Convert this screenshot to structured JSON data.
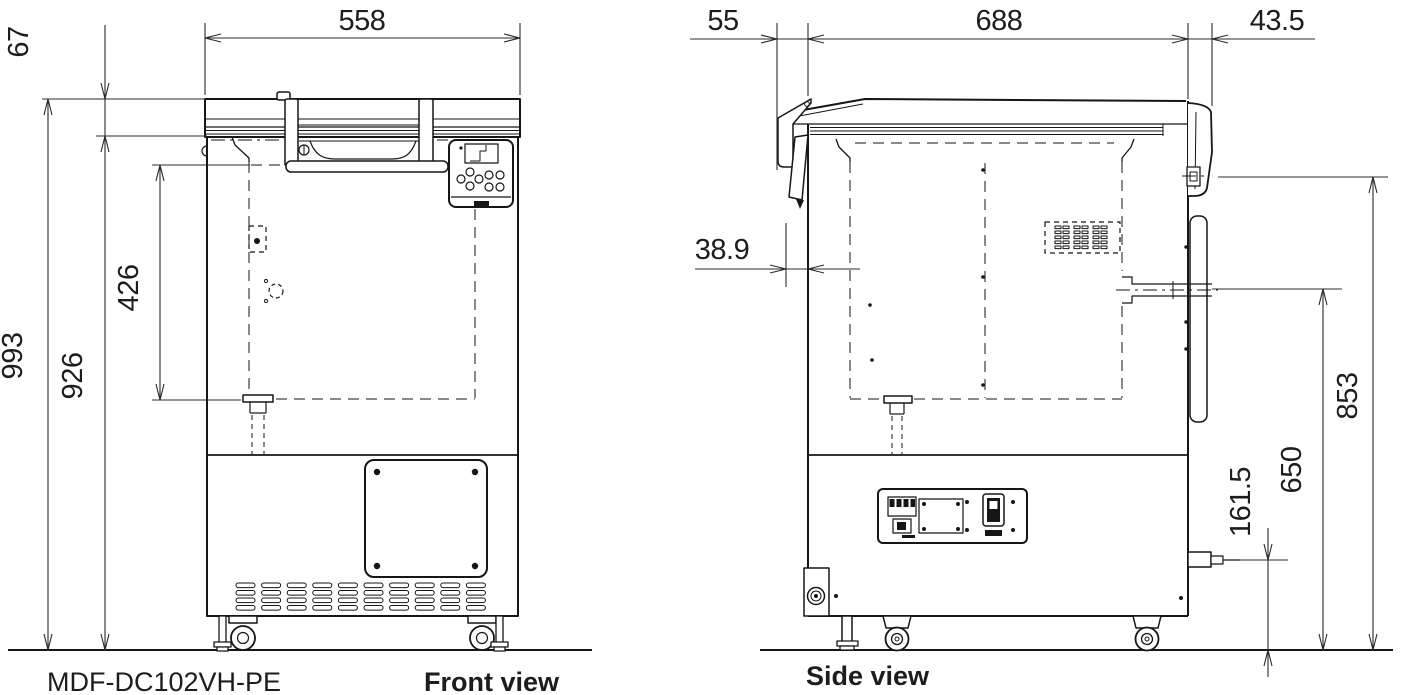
{
  "labels": {
    "model": "MDF-DC102VH-PE",
    "front_view": "Front view",
    "side_view": "Side view"
  },
  "dimensions_mm": {
    "front": {
      "overall_width": "558",
      "lid_thickness": "67",
      "overall_height": "993",
      "body_height": "926",
      "interior_height": "426"
    },
    "side": {
      "back_projection": "55",
      "body_depth": "688",
      "front_projection": "43.5",
      "hinge_projection": "38.9",
      "lid_top_height": "853",
      "access_port_height": "650",
      "outlet_height": "161.5"
    }
  },
  "colors": {
    "line": "#161616",
    "background": "#ffffff"
  }
}
